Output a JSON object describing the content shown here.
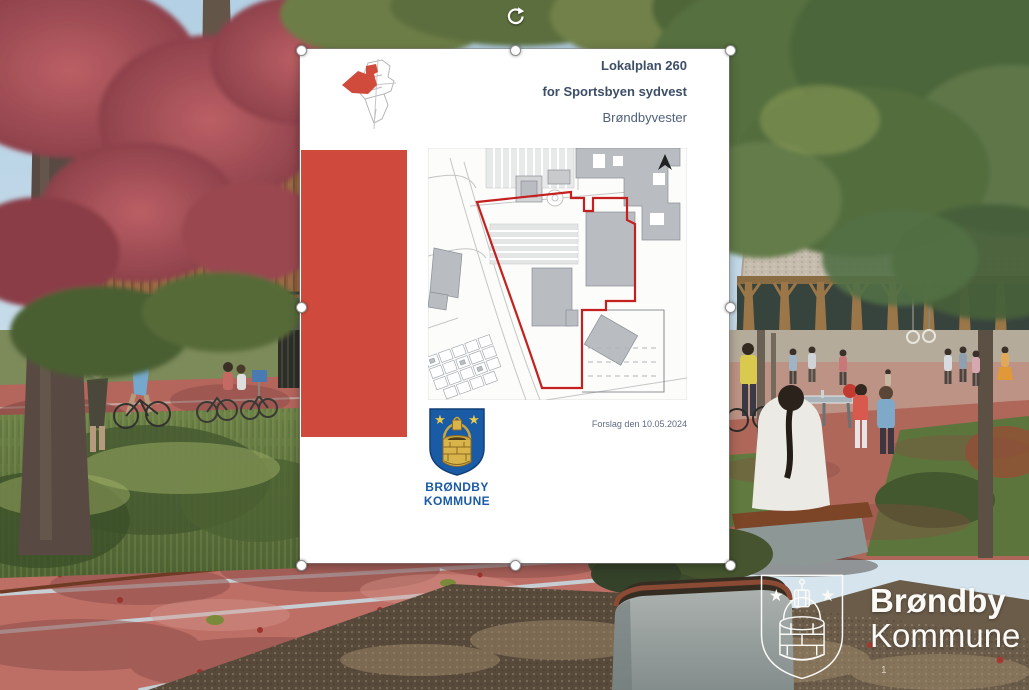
{
  "slide": {
    "page_number": "1",
    "watermark": {
      "line1": "Brøndby",
      "line2": "Kommune"
    }
  },
  "cover": {
    "title_line1": "Lokalplan 260",
    "title_line2": "for Sportsbyen sydvest",
    "subtitle": "Brøndbyvester",
    "date_note": "Forslag den 10.05.2024",
    "crest_caption_line1": "BRØNDBY",
    "crest_caption_line2": "KOMMUNE"
  },
  "colors": {
    "accent_red": "#cf4a3d",
    "boundary_red": "#c4201f",
    "title_blue": "#3d4e68",
    "logo_blue": "#1a5ba6",
    "date_gray": "#5d6b80"
  }
}
